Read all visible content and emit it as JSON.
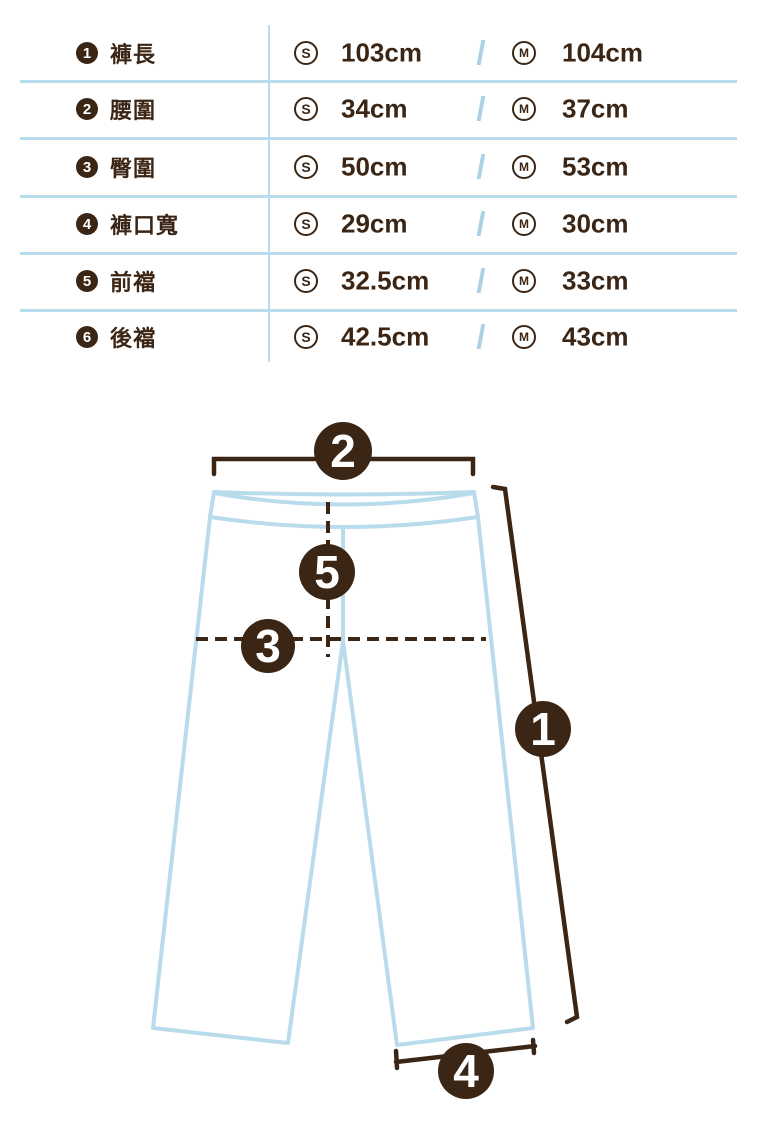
{
  "colors": {
    "brown": "#3B2615",
    "light_blue": "#B9DCEC",
    "slash_blue": "#A9D2E6",
    "number_text": "#FFFFFF"
  },
  "table": {
    "sizes": {
      "s": "S",
      "m": "M"
    },
    "separator": "/",
    "rows": [
      {
        "num": "1",
        "label": "褲長",
        "s_value": "103cm",
        "m_value": "104cm"
      },
      {
        "num": "2",
        "label": "腰圍",
        "s_value": "34cm",
        "m_value": "37cm"
      },
      {
        "num": "3",
        "label": "臀圍",
        "s_value": "50cm",
        "m_value": "53cm"
      },
      {
        "num": "4",
        "label": "褲口寬",
        "s_value": "29cm",
        "m_value": "30cm"
      },
      {
        "num": "5",
        "label": "前襠",
        "s_value": "32.5cm",
        "m_value": "33cm"
      },
      {
        "num": "6",
        "label": "後襠",
        "s_value": "42.5cm",
        "m_value": "43cm"
      }
    ]
  },
  "diagram": {
    "markers": {
      "m1": "1",
      "m2": "2",
      "m3": "3",
      "m4": "4",
      "m5": "5"
    }
  }
}
